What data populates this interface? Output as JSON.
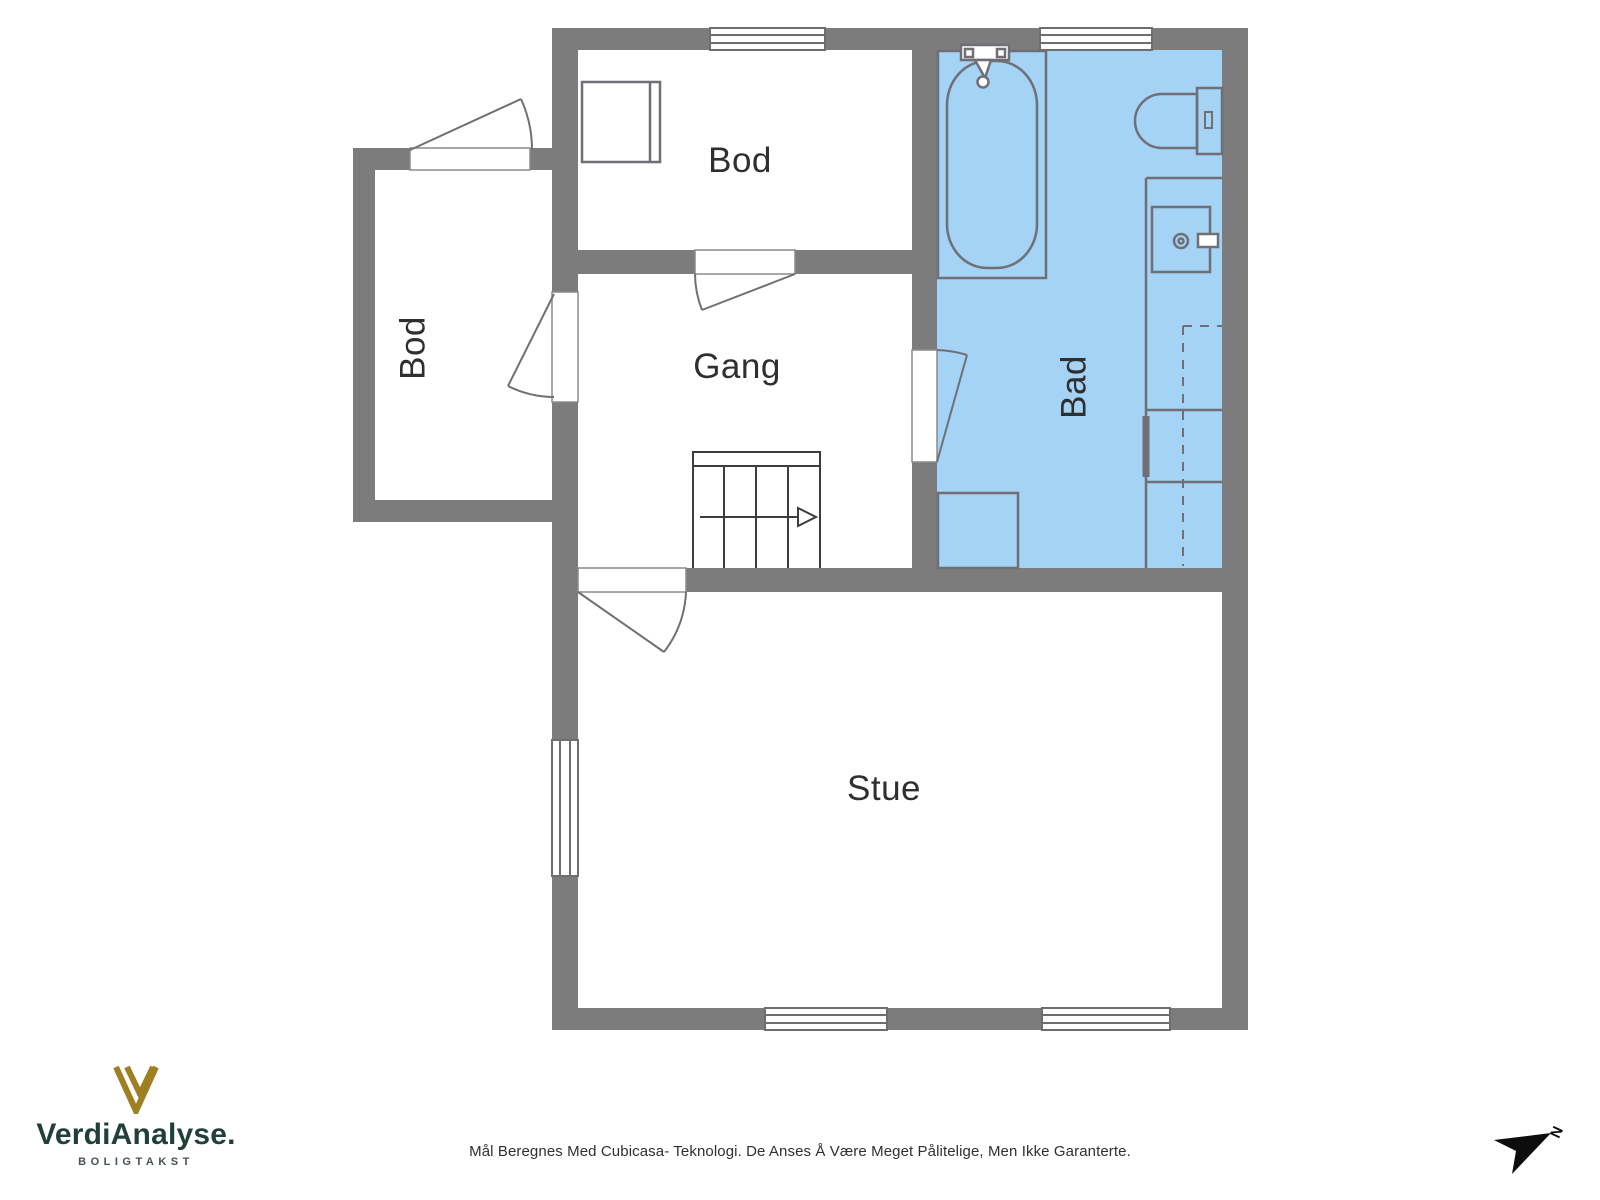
{
  "colors": {
    "wall": "#7c7c7c",
    "bathroom_fill": "#a4d3f5",
    "fixture_outline": "#6f6f75",
    "window_frame": "#6e6e6e",
    "door_outline": "#8a8a8a",
    "stairs": "#3d3d3d",
    "room_label": "#2f2f2f",
    "logo_gold": "#9e7f22",
    "brand_green": "#21403a",
    "compass": "#0d0d0d",
    "disclaimer_text": "#303030"
  },
  "floorplan": {
    "rooms": {
      "bod_top": {
        "label": "Bod"
      },
      "gang": {
        "label": "Gang"
      },
      "bad": {
        "label": "Bad",
        "highlighted": true
      },
      "stue": {
        "label": "Stue"
      },
      "bod_annex": {
        "label": "Bod"
      }
    },
    "fixtures": [
      "bathtub-icon",
      "toilet-icon",
      "sink-icon",
      "vanity-counter-icon",
      "base-cabinet-icon",
      "closet-icon",
      "stairs-icon",
      "door-swing-icon",
      "window-icon"
    ]
  },
  "footer": {
    "brand": "VerdiAnalyse.",
    "tagline": "BOLIGTAKST",
    "disclaimer": "Mål Beregnes Med Cubicasa- Teknologi. De Anses Å Være Meget Pålitelige, Men Ikke Garanterte."
  },
  "compass": {
    "label": "N"
  }
}
